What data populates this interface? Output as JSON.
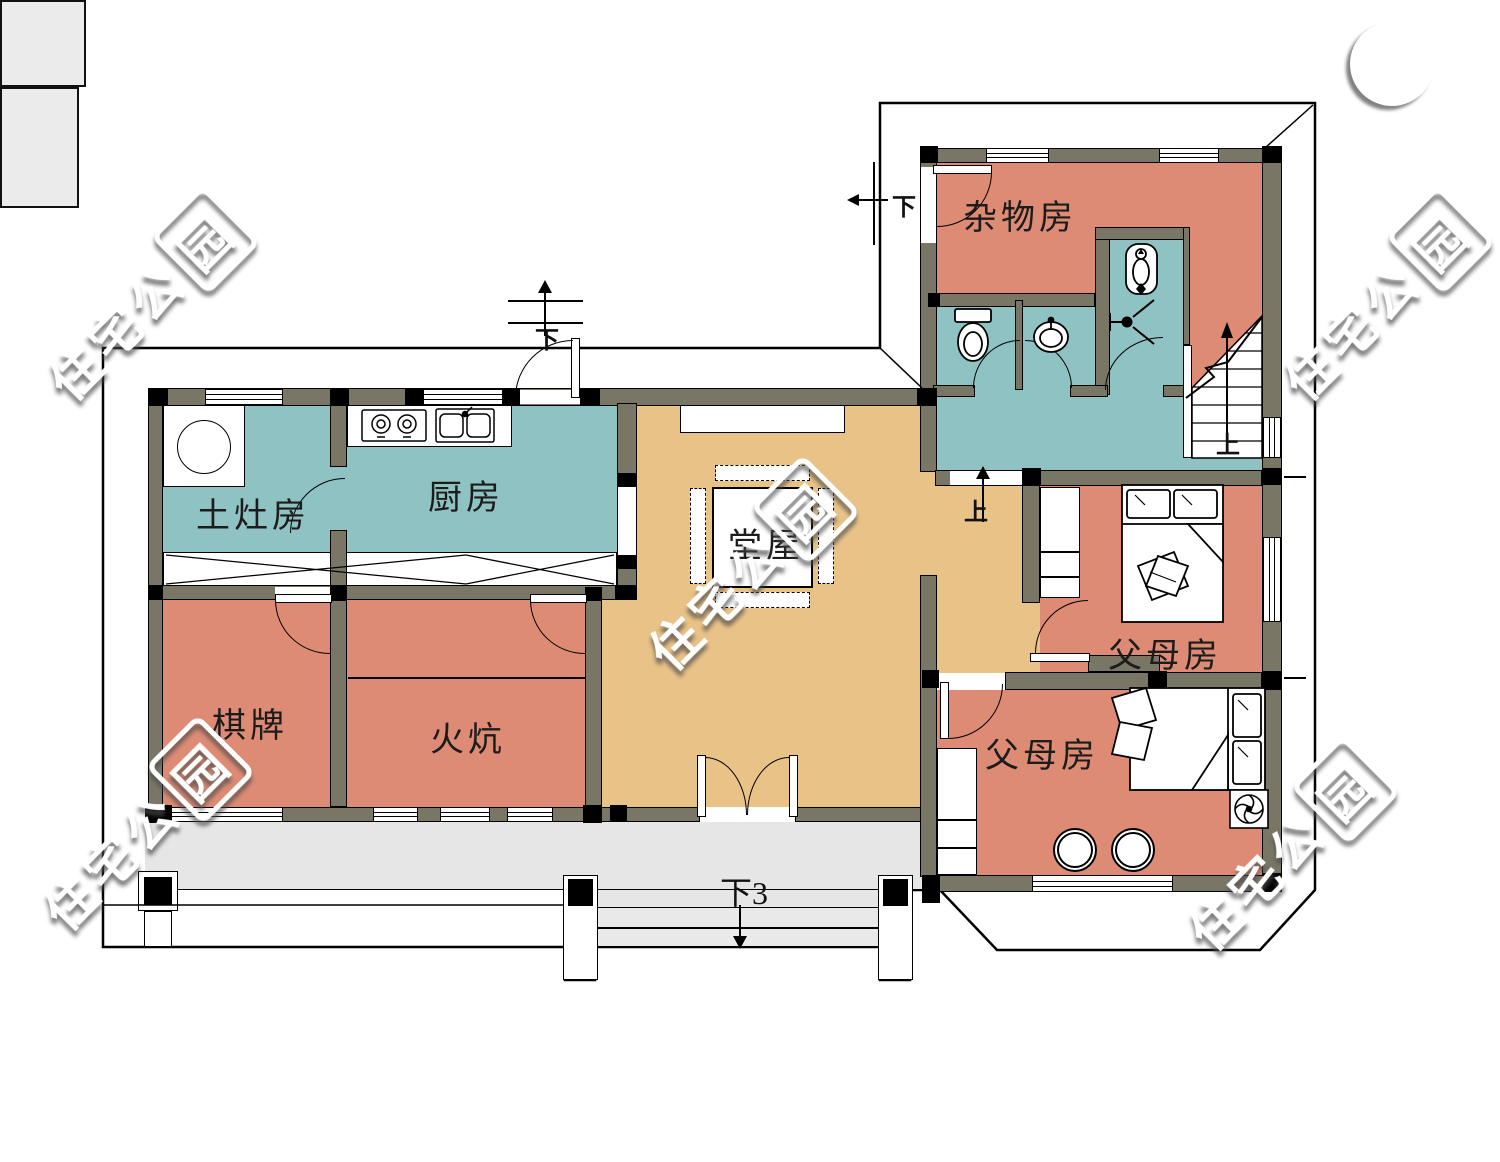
{
  "rooms": {
    "storage": "杂物房",
    "earth_stove": "土灶房",
    "kitchen": "厨房",
    "hall": "堂屋",
    "parents_upper": "父母房",
    "parents_lower": "父母房",
    "chess": "棋牌",
    "kang": "火炕"
  },
  "directions": {
    "down_side": "下",
    "down_back": "下",
    "up_hall": "上",
    "up_stairs": "上",
    "down3_entry": "下3"
  },
  "watermark": {
    "text": "住宅公",
    "logo_char": "园"
  },
  "colors": {
    "teal": "#8fc2c2",
    "salmon": "#dd8b74",
    "tan": "#e9c287",
    "wall": "#7a7666",
    "porch": "#e6e6e6"
  }
}
